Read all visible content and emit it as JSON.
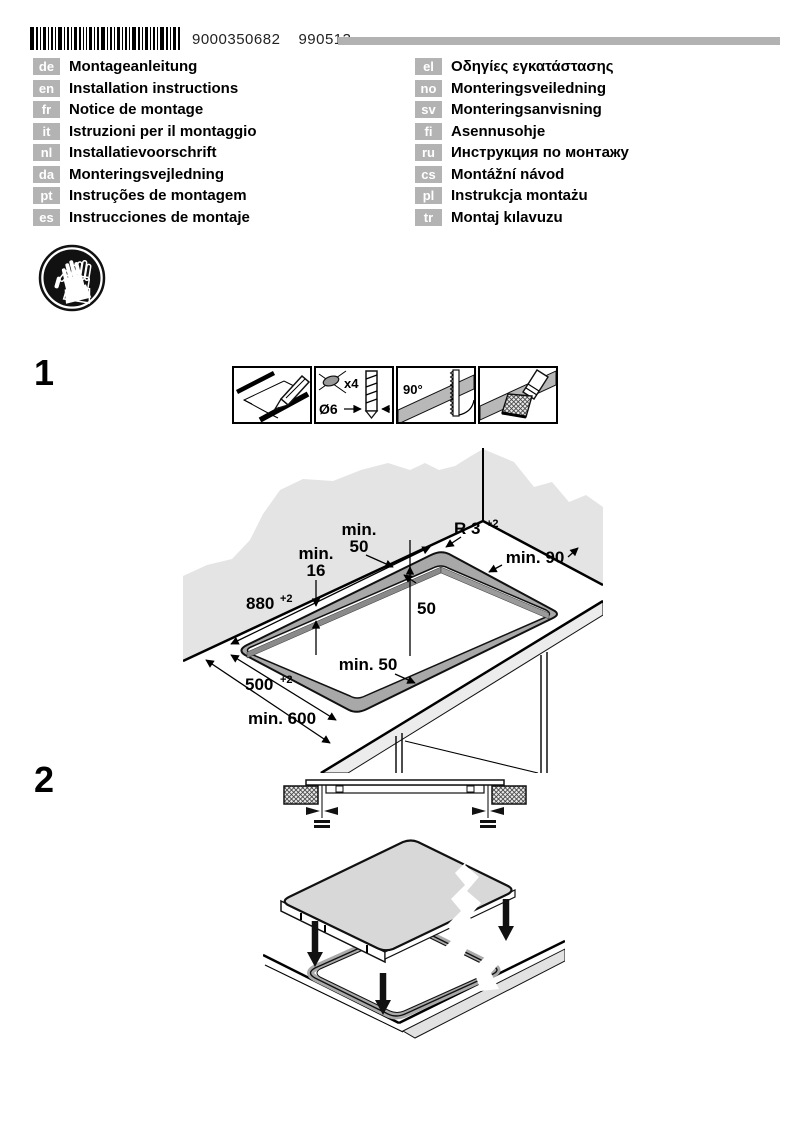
{
  "header": {
    "code_number": "9000350682",
    "code_date": "990513"
  },
  "languages": {
    "left": [
      {
        "code": "de",
        "title": "Montageanleitung"
      },
      {
        "code": "en",
        "title": "Installation instructions"
      },
      {
        "code": "fr",
        "title": "Notice de montage"
      },
      {
        "code": "it",
        "title": "Istruzioni per il montaggio"
      },
      {
        "code": "nl",
        "title": "Installatievoorschrift"
      },
      {
        "code": "da",
        "title": "Monteringsvejledning"
      },
      {
        "code": "pt",
        "title": "Instruções de montagem"
      },
      {
        "code": "es",
        "title": "Instrucciones de montaje"
      }
    ],
    "right": [
      {
        "code": "el",
        "title": "Οδηγίες εγκατάστασης"
      },
      {
        "code": "no",
        "title": "Monteringsveiledning"
      },
      {
        "code": "sv",
        "title": "Monteringsanvisning"
      },
      {
        "code": "fi",
        "title": "Asennusohje"
      },
      {
        "code": "ru",
        "title": "Инструкция по монтажу"
      },
      {
        "code": "cs",
        "title": "Montážní návod"
      },
      {
        "code": "pl",
        "title": "Instrukcja montażu"
      },
      {
        "code": "tr",
        "title": "Montaj kılavuzu"
      }
    ]
  },
  "icons": {
    "safety": "protective-gloves",
    "tools": [
      "pencil-marking",
      "drill-holes",
      "saw-cut-90-degrees",
      "seal-edges-brush"
    ]
  },
  "steps": {
    "step1": "1",
    "step2": "2"
  },
  "tools": {
    "drill_count": "x4",
    "drill_diameter": "Ø6",
    "angle": "90°"
  },
  "diagram": {
    "d880": "880",
    "d880_sup": "+2",
    "min16_l1": "min.",
    "min16_l2": "16",
    "min50_top_l1": "min.",
    "min50_top_l2": "50",
    "r3": "R 3",
    "r3_sup": "+2",
    "min90": "min. 90",
    "d50": "50",
    "min50_bottom": "min. 50",
    "d500": "500",
    "d500_sup": "+2",
    "min600": "min. 600"
  },
  "colors": {
    "wall_gray": "#e4e4e4",
    "rim_gray": "#a8a8a8",
    "band_gray": "#b8b8b8",
    "bar_gray": "#b2b2b2"
  }
}
